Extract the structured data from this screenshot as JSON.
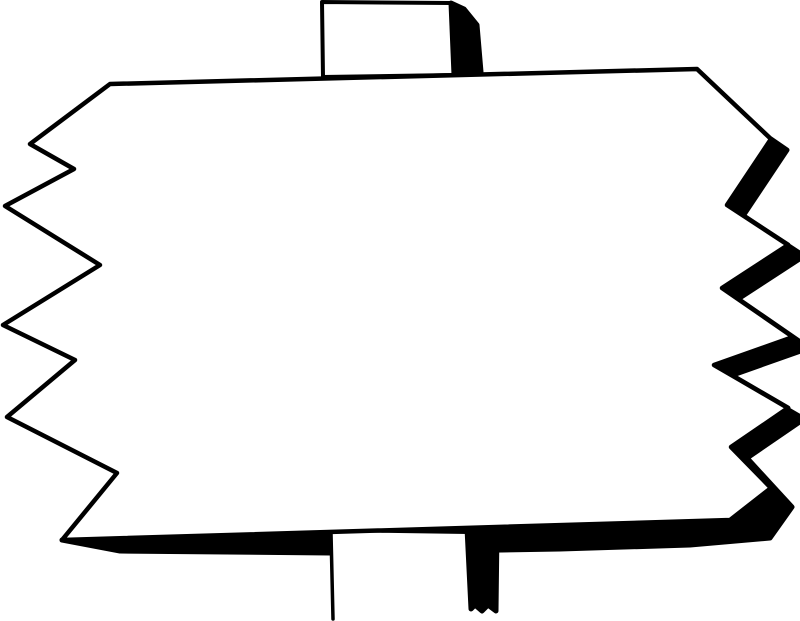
{
  "meta": {
    "title": "Blank signpost clipart",
    "description": "Black and white line-art drawing of a blank rectangular sign with jagged zigzag left and right edges, mounted on a vertical post; heavy black shadow along the right zigzag edge and bottom edge.",
    "text_content": ""
  },
  "colors": {
    "ink": "#000000",
    "background": "#ffffff"
  },
  "shapes": {
    "sign_face_points": "110,84 697,69 771,139 727,205 788,245 722,288 793,337 714,365 788,408 731,447 771,488 730,520 62,540 117,473 7,417 75,360 3,325 100,265 5,206 74,169 30,144",
    "shadow_points": "771,139 727,205 788,245 722,288 793,337 714,365 788,408 731,447 771,488 730,520 62,540 120,551 330,553 560,549 690,545 770,538 792,507 747,458 804,419 730,376 809,348 738,299 804,256 743,216 787,150",
    "top_post_face_points": "322,2 451,3 454,75 323,77",
    "top_post_shadow_points": "451,3 464,9 477,25 481,72 454,75",
    "bottom_post_face_points": "331,532 468,534 470,621 332,621",
    "bottom_post_shadow_points": "467,528 497,529 496,611 488,605 482,611 475,605 471,609",
    "bottom_post_left_line_points": "331,533 333,619"
  }
}
